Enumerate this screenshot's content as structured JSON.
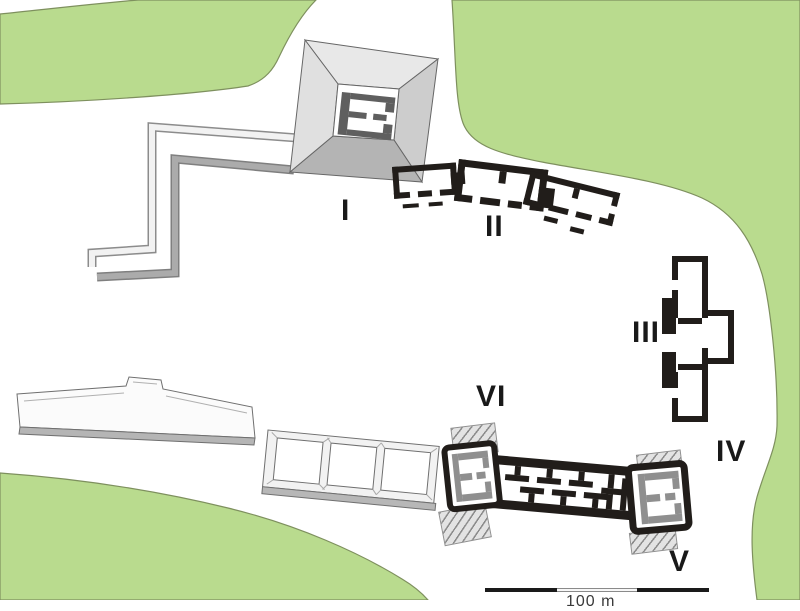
{
  "map": {
    "type": "archaeological-site-plan",
    "colors": {
      "vegetation": "#b9db8e",
      "vegetation_outline": "#7e905e",
      "cleared_ground": "#ffffff",
      "excavated_structures": "#211d1a",
      "restored_structures_gray": "#c9c9c9"
    },
    "labels": {
      "s1": "I",
      "s2": "II",
      "s3": "III",
      "s4": "IV",
      "s5": "V",
      "s6": "VI"
    },
    "scale_bar": {
      "label": "100 m",
      "segments": 3
    }
  }
}
